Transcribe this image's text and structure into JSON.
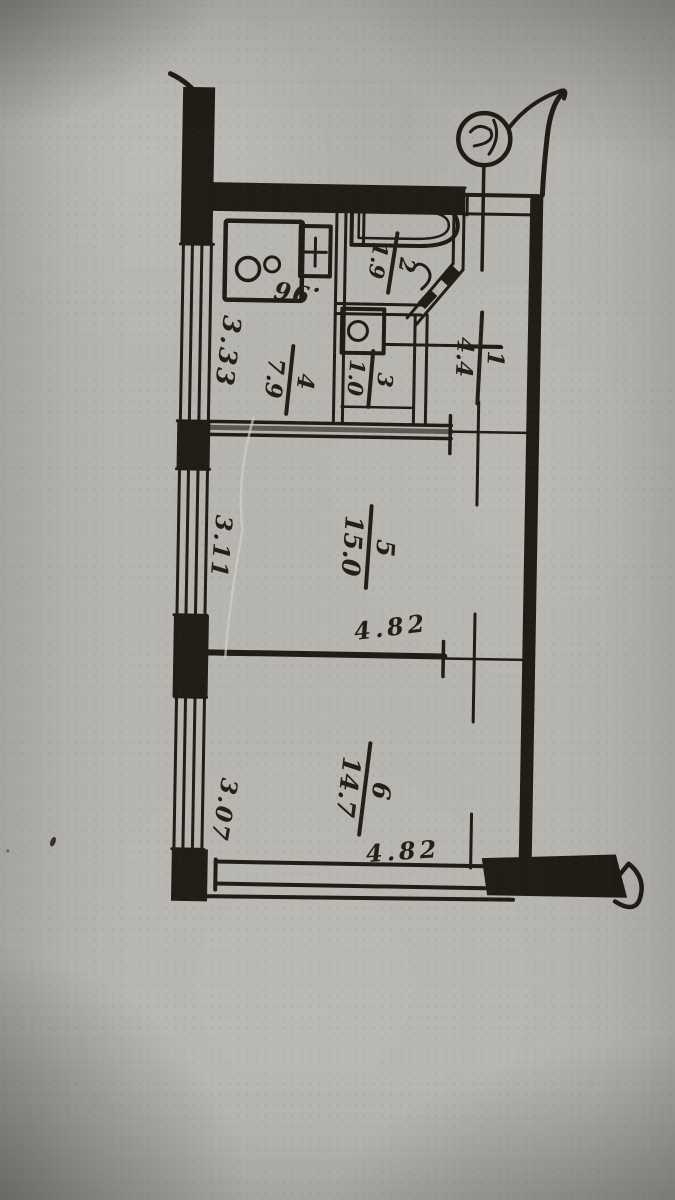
{
  "plan": {
    "rooms": [
      {
        "number": "1",
        "area": "4.4"
      },
      {
        "number": "2",
        "area": "1.9"
      },
      {
        "number": "3",
        "area": "1.0"
      },
      {
        "number": "4",
        "area": "7.9"
      },
      {
        "number": "5",
        "area": "15.0"
      },
      {
        "number": "6",
        "area": "14.7"
      }
    ],
    "dimensions": {
      "kitchen_window": "3.33",
      "kitchen_inner": ".96",
      "room5_window": "3.11",
      "room5_width": "4.82",
      "room6_window": "3.07",
      "room6_width": "4.82"
    },
    "ink_color": "#201c16",
    "paper_color": "#b7b5b0"
  }
}
